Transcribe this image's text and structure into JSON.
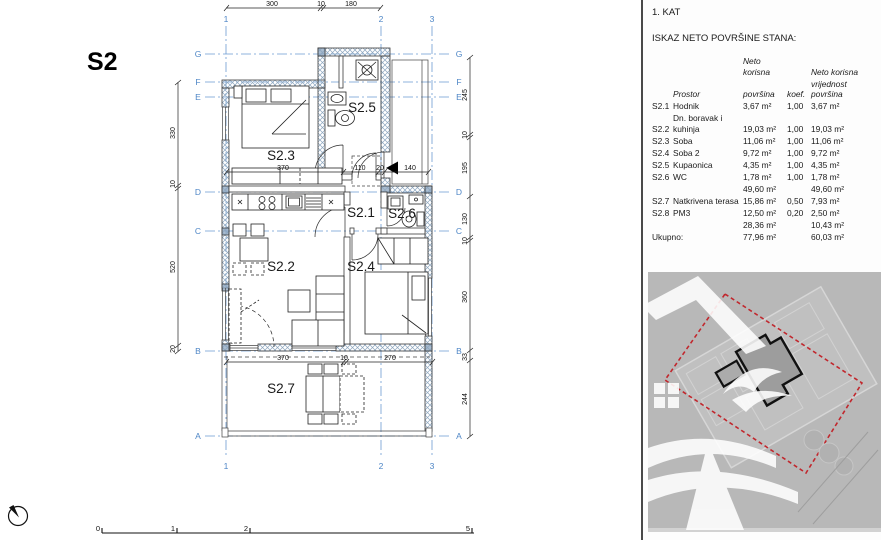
{
  "plan": {
    "unit_label": "S2",
    "room_labels": [
      "S2.1",
      "S2.2",
      "S2.3",
      "S2.4",
      "S2.5",
      "S2.6",
      "S2.7"
    ],
    "grid_cols": [
      "1",
      "2",
      "3"
    ],
    "grid_rows": [
      "G",
      "F",
      "E",
      "D",
      "C",
      "B",
      "A"
    ],
    "dims": {
      "top": [
        "300",
        "10",
        "180"
      ],
      "left": [
        "330",
        "10",
        "520",
        "20"
      ],
      "right": [
        "245",
        "10",
        "195",
        "130",
        "10",
        "360",
        "33",
        "244"
      ],
      "mid": [
        "370",
        "110",
        "20",
        "140"
      ],
      "bottom": [
        "370",
        "10",
        "270"
      ]
    },
    "colors": {
      "grid_blue": "#5a8fc4",
      "hatch": "#8da6bf",
      "line": "#2a2a2a"
    }
  },
  "scalebar": {
    "labels": [
      "0",
      "1",
      "2",
      "5"
    ]
  },
  "panel": {
    "floor": "1. KAT",
    "subtitle": "ISKAZ NETO POVRŠINE STANA:",
    "table": {
      "headers": {
        "prostor": "Prostor",
        "area_line1": "Neto korisna",
        "area_line2": "površina",
        "koef": "koef.",
        "val_line1": "Neto korisna",
        "val_line2": "vrijednost površina"
      },
      "rows": [
        {
          "id": "S2.1",
          "name": "Hodnik",
          "area": "3,67 m²",
          "koef": "1,00",
          "value": "3,67 m²"
        },
        {
          "id": "S2.2",
          "name": "Dn. boravak i kuhinja",
          "area": "19,03 m²",
          "koef": "1,00",
          "value": "19,03 m²"
        },
        {
          "id": "S2.3",
          "name": "Soba",
          "area": "11,06 m²",
          "koef": "1,00",
          "value": "11,06 m²"
        },
        {
          "id": "S2.4",
          "name": "Soba 2",
          "area": "9,72 m²",
          "koef": "1,00",
          "value": "9,72 m²"
        },
        {
          "id": "S2.5",
          "name": "Kupaonica",
          "area": "4,35 m²",
          "koef": "1,00",
          "value": "4,35 m²"
        },
        {
          "id": "S2.6",
          "name": "WC",
          "area": "1,78 m²",
          "koef": "1,00",
          "value": "1,78 m²"
        }
      ],
      "subtotal1": {
        "area": "49,60 m²",
        "value": "49,60 m²"
      },
      "rows2": [
        {
          "id": "S2.7",
          "name": "Natkrivena terasa",
          "area": "15,86 m²",
          "koef": "0,50",
          "value": "7,93 m²"
        },
        {
          "id": "S2.8",
          "name": "PM3",
          "area": "12,50 m²",
          "koef": "0,20",
          "value": "2,50 m²"
        }
      ],
      "subtotal2": {
        "area": "28,36 m²",
        "value": "10,43 m²"
      },
      "total": {
        "label": "Ukupno:",
        "area": "77,96 m²",
        "value": "60,03 m²"
      }
    }
  },
  "siteplan": {
    "bg": "#b8b8b8",
    "boundary_color": "#c1272d",
    "unit_color": "#111111"
  }
}
